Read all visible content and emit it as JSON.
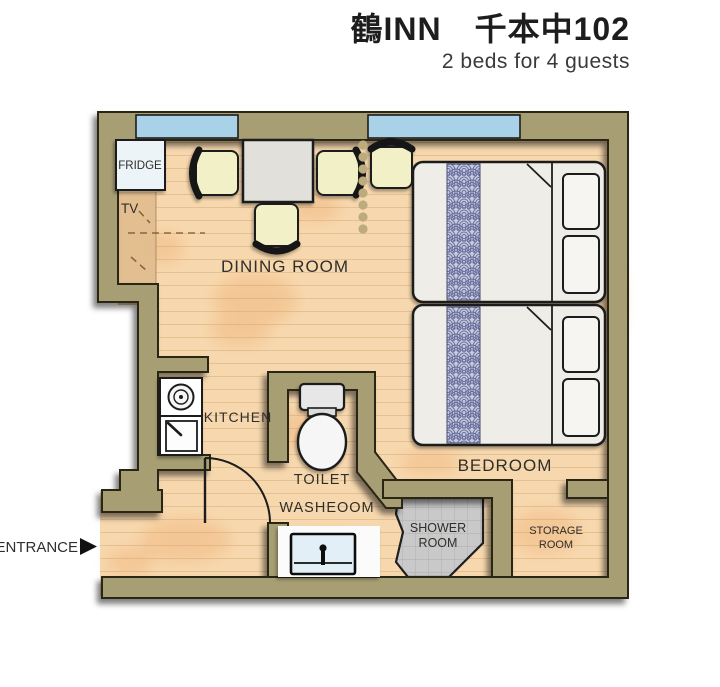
{
  "header": {
    "title": "鶴INN　千本中102",
    "subtitle": "2 beds for 4 guests"
  },
  "labels": {
    "dining_room": "DINING ROOM",
    "bedroom": "BEDROOM",
    "kitchen": "KITCHEN",
    "toilet": "TOILET",
    "washroom": "WASHEOOM",
    "shower_line1": "SHOWER",
    "shower_line2": "ROOM",
    "storage_line1": "STORAGE",
    "storage_line2": "ROOM",
    "fridge": "FRIDGE",
    "tv": "TV",
    "entrance": "ENTRANCE"
  },
  "icons": {
    "entrance_arrow": "right-pointing-triangle"
  },
  "capacity": {
    "beds": 2,
    "guests": 4
  },
  "colors": {
    "wall": "#a79e73",
    "outline": "#2c2718",
    "floor": "#f7d8ae",
    "window_glass": "#a9d2e9",
    "shower_tile": "#cbcbcb",
    "bed_runner_blue": "#666c9c",
    "chair_seat": "#f1f0c6",
    "sink_blue": "#e2eff6",
    "fridge_fill": "#edf4f8"
  }
}
